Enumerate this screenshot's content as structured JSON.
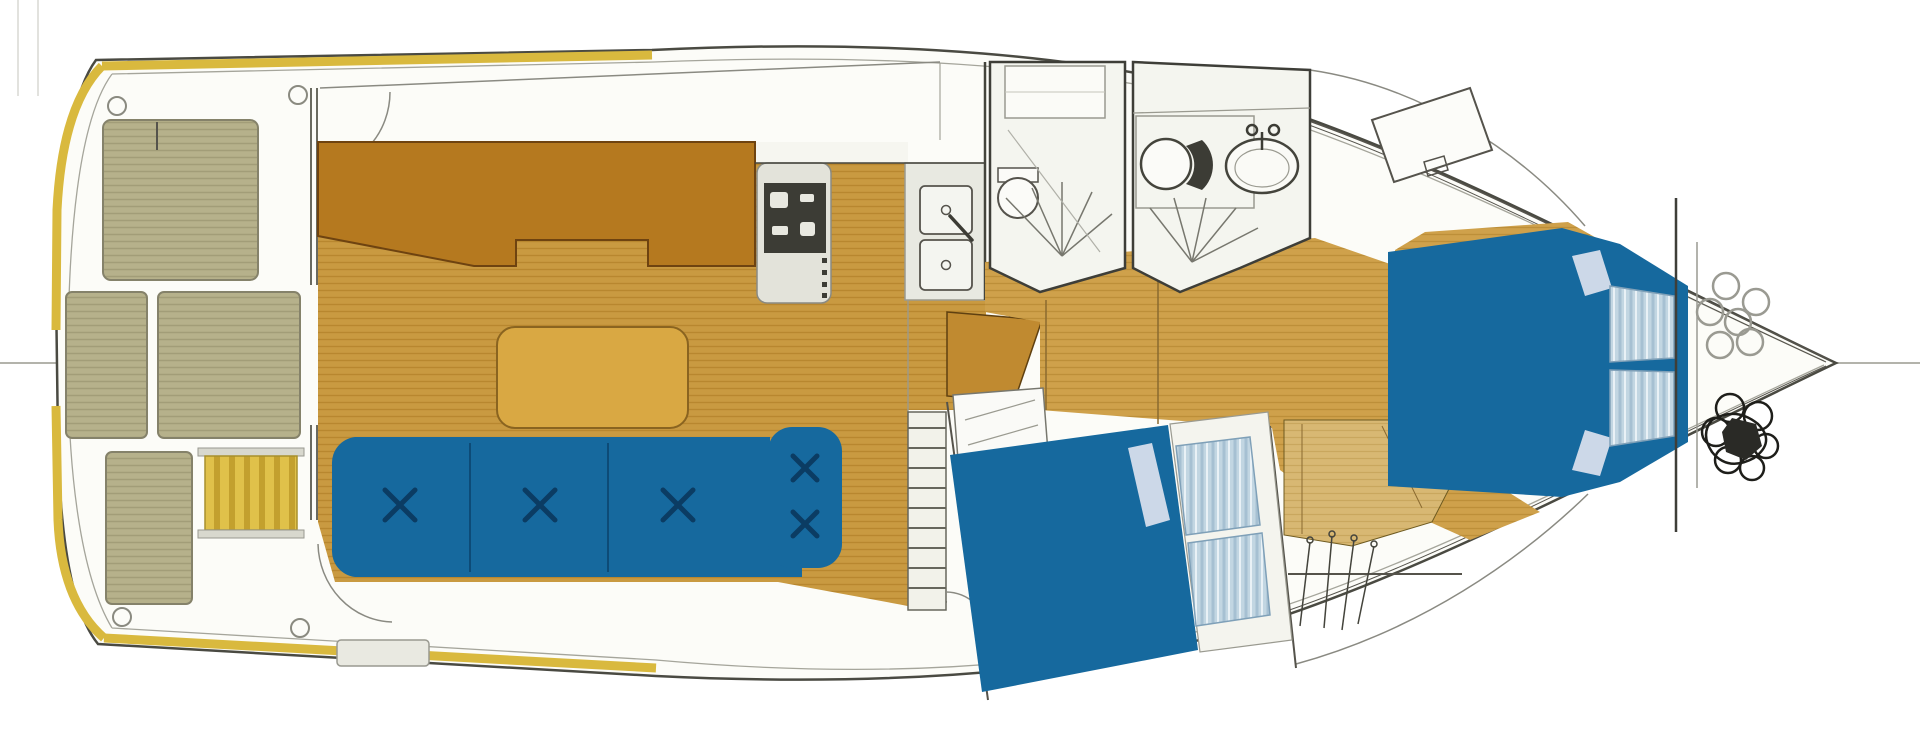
{
  "diagram": {
    "type": "boat-floorplan",
    "title": "Motor yacht interior layout, plan view",
    "orientation": {
      "stern": "left",
      "bow": "right"
    },
    "areas": [
      {
        "name": "aft-deck",
        "features": [
          "teak deck hatches",
          "engine vent hatch",
          "yellow gunwale band",
          "mooring hoops"
        ]
      },
      {
        "name": "salon",
        "features": [
          "L-sofa with 3 tufted cushions",
          "armchair with 2 tufted cushions",
          "coffee table",
          "teak plank floor"
        ]
      },
      {
        "name": "galley",
        "features": [
          "counter",
          "stove with burner panel",
          "double sink with faucet"
        ]
      },
      {
        "name": "head-port",
        "features": [
          "toilet",
          "shower spray",
          "deck window"
        ]
      },
      {
        "name": "head-starboard",
        "features": [
          "toilet",
          "washbasin",
          "shower spray"
        ]
      },
      {
        "name": "mid-cabin",
        "features": [
          "double berth",
          "two striped pillows",
          "companionway steps",
          "desk panel"
        ]
      },
      {
        "name": "hanging-locker",
        "features": [
          "closet rod",
          "hangers"
        ]
      },
      {
        "name": "forward-cabin",
        "features": [
          "V-berth",
          "two striped pillows",
          "deck hatch"
        ]
      },
      {
        "name": "chain-locker",
        "features": [
          "chain links",
          "anchor rode pile"
        ]
      }
    ]
  },
  "colors": {
    "deck_white": "#fcfcf8",
    "hull_outline": "#4a4a42",
    "inner_line": "#a5a59b",
    "gunwale_yellow": "#d9b93e",
    "hatch_khaki": "#b6b18b",
    "teak_floor": "#c99a41",
    "corridor_floor": "#cfa14b",
    "pale_wood": "#d8b873",
    "cabinet_brown": "#b5791f",
    "step_brown": "#c08a30",
    "upholstery_blue": "#16699e",
    "tuft_navy": "#0b3c63",
    "pillow_blue": "#c2d6e2",
    "table_tan": "#d9a843",
    "stove_black": "#3c3c35",
    "line_grey": "#8a8a82",
    "guide_grey": "#b3b3ab"
  }
}
